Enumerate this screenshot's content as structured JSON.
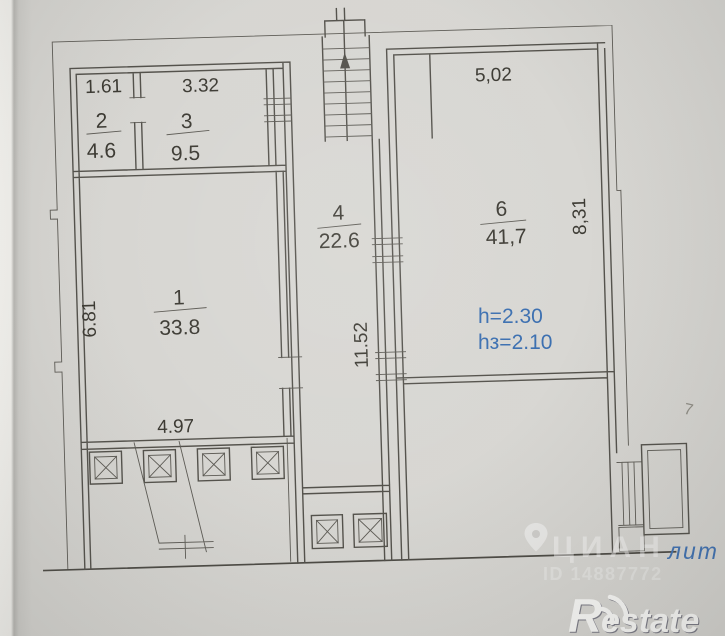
{
  "scan": {
    "paper_color": "#d8d7d3",
    "line_color": "#54524c",
    "rooms": {
      "room1": {
        "number": "1",
        "area": "33.8",
        "left_dim": "6.81",
        "bottom_dim": "4.97"
      },
      "room2": {
        "number": "2",
        "area": "4.6",
        "top_dim": "1.61"
      },
      "room3": {
        "number": "3",
        "area": "9.5",
        "top_dim": "3.32"
      },
      "room4": {
        "number": "4",
        "area": "22.6",
        "side_dim": "11.52"
      },
      "room6": {
        "number": "6",
        "area": "41,7",
        "top_dim": "5,02",
        "right_dim": "8,31"
      }
    },
    "annotations": {
      "annotation_color": "#3b6fb0",
      "height_note_line1": "h=2.30",
      "height_note_line2": "hз=2.10",
      "liter_label": "лит",
      "pencil_mark": "7"
    }
  },
  "overlay": {
    "watermark_brand": "ЦИАН",
    "watermark_id": "ID 14887772",
    "agency_logo": "Restate"
  }
}
